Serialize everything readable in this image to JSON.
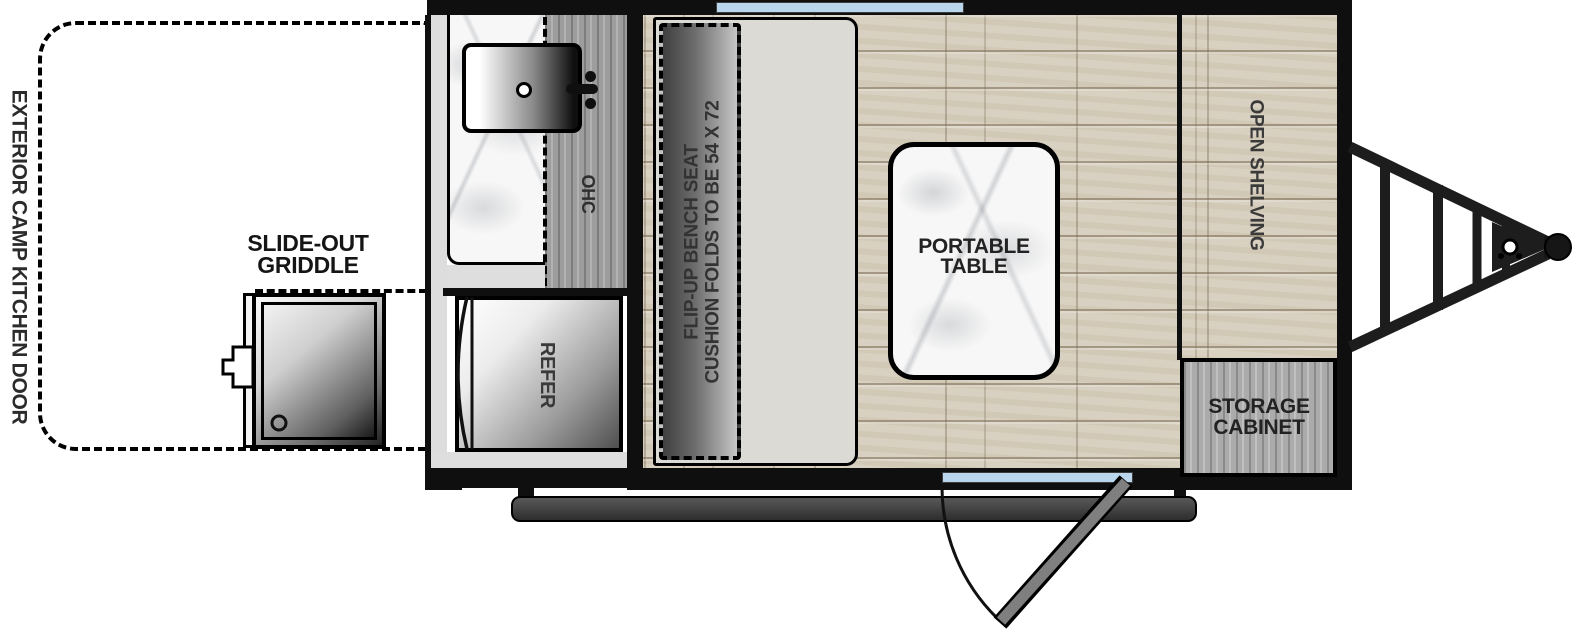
{
  "diagram": {
    "type": "travel-trailer floorplan, top view",
    "labels": {
      "exterior_door": "EXTERIOR CAMP KITCHEN DOOR",
      "slide_out_griddle": "SLIDE-OUT\nGRIDDLE",
      "ohc": "OHC",
      "refer": "REFER",
      "bench": "FLIP-UP BENCH SEAT\nCUSHION FOLDS TO BE 54 X 72",
      "portable_table": "PORTABLE\nTABLE",
      "open_shelving": "OPEN SHELVING",
      "storage_cabinet": "STORAGE\nCABINET"
    },
    "colors": {
      "wall": "#0f0f0f",
      "window_blue": "#b9d6ec",
      "floor_wood": "#d8d0c0",
      "cabinet_gray_wood": "#9d9d9d",
      "platform_gray": "#dcdad5",
      "step_gray": "#3a3a3a",
      "door_panel_gray": "#7f7f7f",
      "label_text": "#2b2b2b"
    }
  }
}
